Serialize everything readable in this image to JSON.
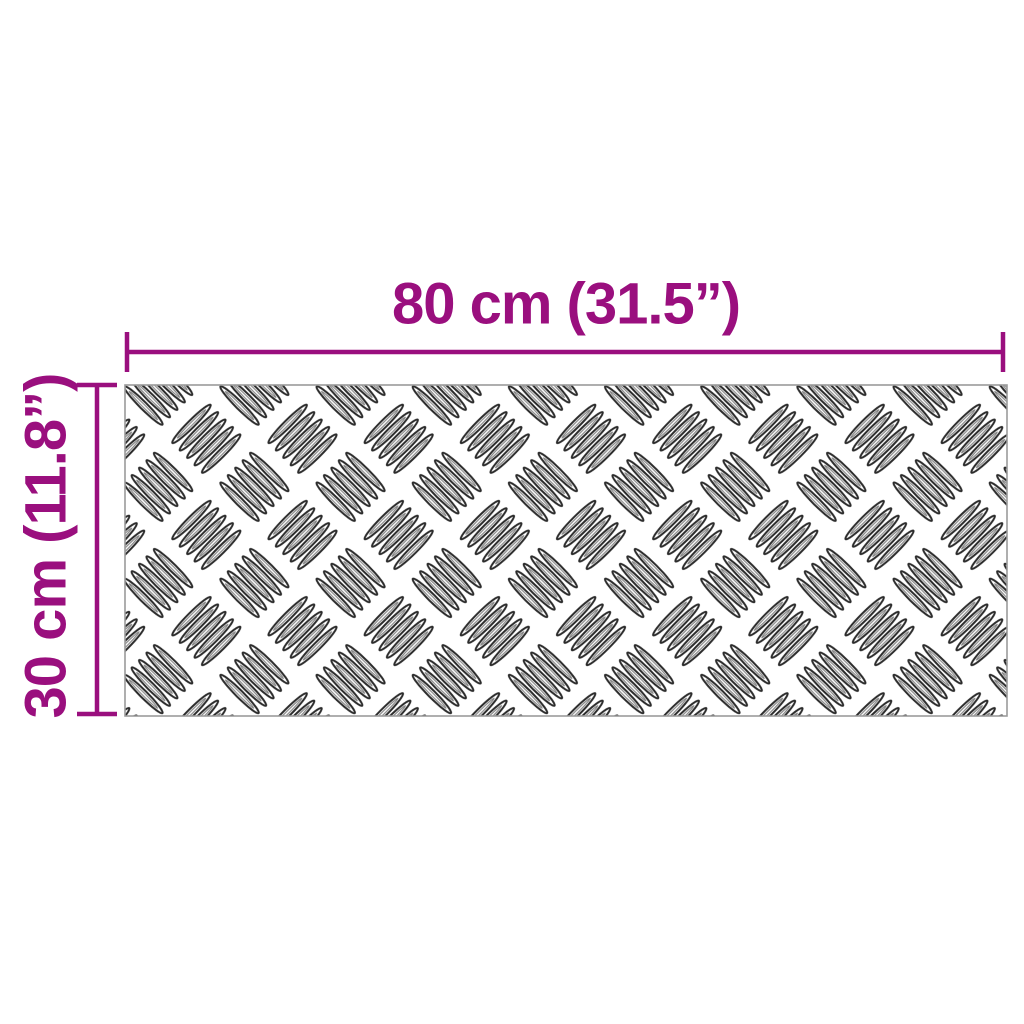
{
  "diagram": {
    "type": "product-dimension-diagram",
    "object": "checker-plate-sheet",
    "dimensions": {
      "width_label": "80 cm (31.5”)",
      "height_label": "30 cm (11.8”)"
    }
  },
  "colors": {
    "dimension": "#9a0f7e",
    "plate_border": "#9b9b9b",
    "pattern_stroke": "#2b2b2b",
    "background": "#ffffff"
  }
}
